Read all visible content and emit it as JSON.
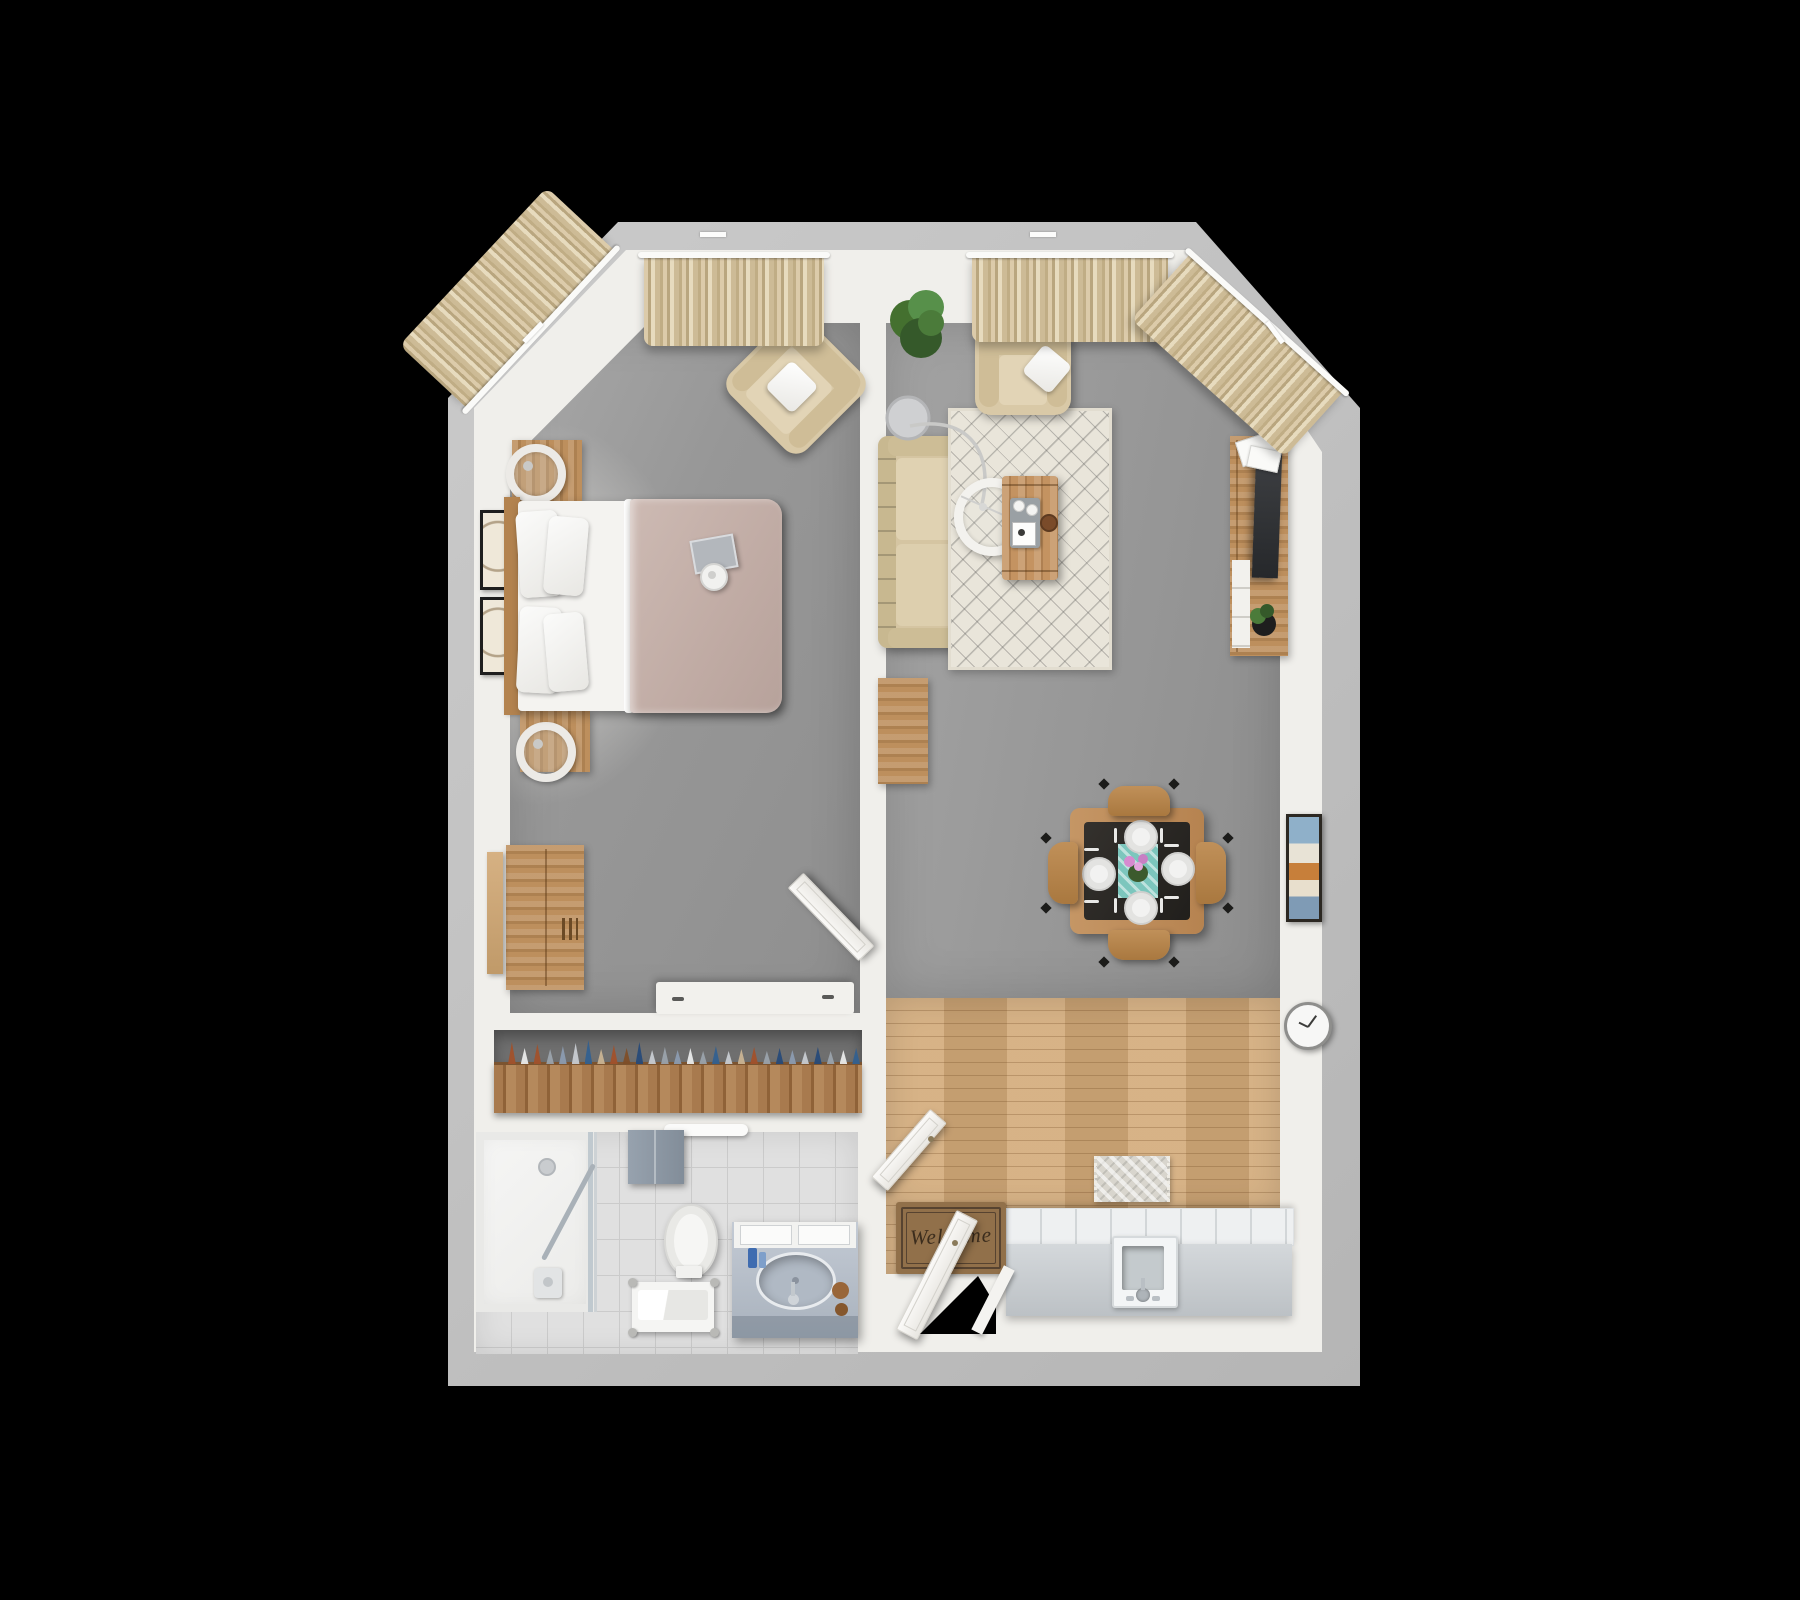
{
  "entry_mat": {
    "text": "Welcome"
  },
  "closet": {
    "hangers": [
      {
        "c": "#a1512b",
        "h": 22
      },
      {
        "c": "#e9eaea",
        "h": 16
      },
      {
        "c": "#a1512b",
        "h": 20
      },
      {
        "c": "#9aa2ab",
        "h": 15
      },
      {
        "c": "#8b9bb0",
        "h": 18
      },
      {
        "c": "#c7cbd1",
        "h": 21
      },
      {
        "c": "#33608f",
        "h": 24
      },
      {
        "c": "#c9b392",
        "h": 15
      },
      {
        "c": "#a1512b",
        "h": 19
      },
      {
        "c": "#7e4e28",
        "h": 16
      },
      {
        "c": "#274a78",
        "h": 22
      },
      {
        "c": "#c7cbd1",
        "h": 14
      },
      {
        "c": "#9aa2ab",
        "h": 17
      },
      {
        "c": "#8b9bb0",
        "h": 14
      },
      {
        "c": "#e9eaea",
        "h": 16
      },
      {
        "c": "#9aa2ab",
        "h": 13
      },
      {
        "c": "#33608f",
        "h": 18
      },
      {
        "c": "#c7cbd1",
        "h": 13
      },
      {
        "c": "#c9b392",
        "h": 15
      },
      {
        "c": "#a1512b",
        "h": 17
      },
      {
        "c": "#9aa2ab",
        "h": 13
      },
      {
        "c": "#274a78",
        "h": 16
      },
      {
        "c": "#8b9bb0",
        "h": 14
      },
      {
        "c": "#c7cbd1",
        "h": 13
      },
      {
        "c": "#274a78",
        "h": 17
      },
      {
        "c": "#9aa2ab",
        "h": 13
      },
      {
        "c": "#e9eaea",
        "h": 14
      },
      {
        "c": "#33608f",
        "h": 16
      }
    ]
  },
  "palette": {
    "bg": "#000000",
    "wall_outer": "#c2c2c2",
    "wall_inner": "#f0efeb",
    "floor_grey": "#9b9b9b",
    "wood": "#bd8f5d",
    "wood_floor": "#d3aa79",
    "closet_wood": "#a87a4e",
    "cream_sofa": "#d5c5a2",
    "curtain_beige": "#d7c6a3",
    "duvet_mauve": "#c4b0a9",
    "rug_cream": "#e9e5da",
    "counter_grey": "#c7cbcf",
    "tile": "#e0e0e0",
    "marble": "#b6bec9",
    "towel_grey": "#8d98a4",
    "runner_teal": "#7cc6bd",
    "mat_brown": "#91704a",
    "tv_dark": "#35373a",
    "plant_green": "#4b7b3a",
    "accent_rust": "#a1512b",
    "accent_blue": "#33608f"
  }
}
